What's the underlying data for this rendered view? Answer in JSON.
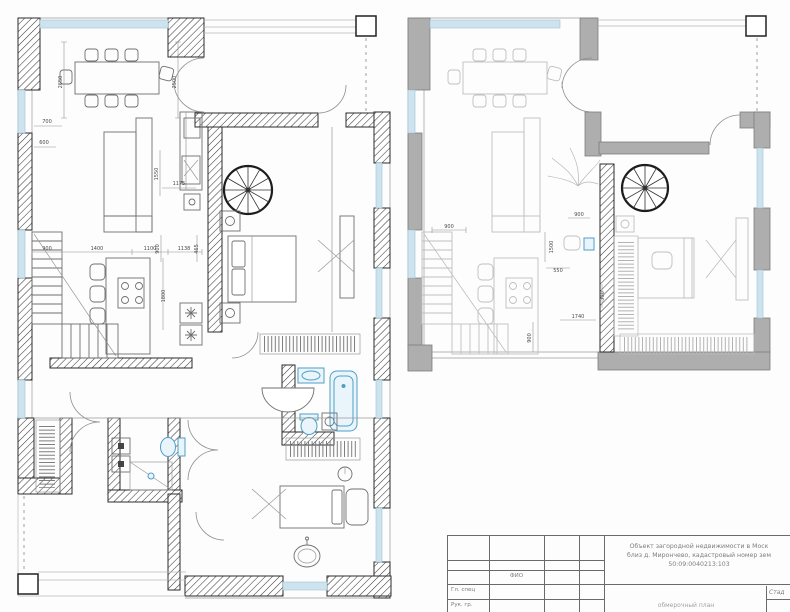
{
  "plans": {
    "left": {
      "dims": [
        "700",
        "600",
        "2650",
        "2500",
        "1550",
        "1175",
        "900",
        "1400",
        "1100",
        "900",
        "1138",
        "465",
        "1800"
      ]
    },
    "right": {
      "dims": [
        "900",
        "900",
        "1500",
        "550",
        "300",
        "1740",
        "900"
      ]
    }
  },
  "title_block": {
    "fio_header": "ФИО",
    "row1_label": "Гл. спец",
    "row2_label": "Рук. гр.",
    "project_line1": "Объект загородной недвижимости в Моск",
    "project_line2": "близ д. Мирончево, кадастровый номер зем",
    "project_line3": "50:09:0040213:103",
    "stage_label": "Стад",
    "drawing_title": "обмерочный план"
  },
  "colors": {
    "window_blue": "#cde3ee",
    "fixture_blue": "#4e9fc7",
    "wall_hatch_dark": "#2b2b2b",
    "wall_gray": "#aeaeae"
  }
}
